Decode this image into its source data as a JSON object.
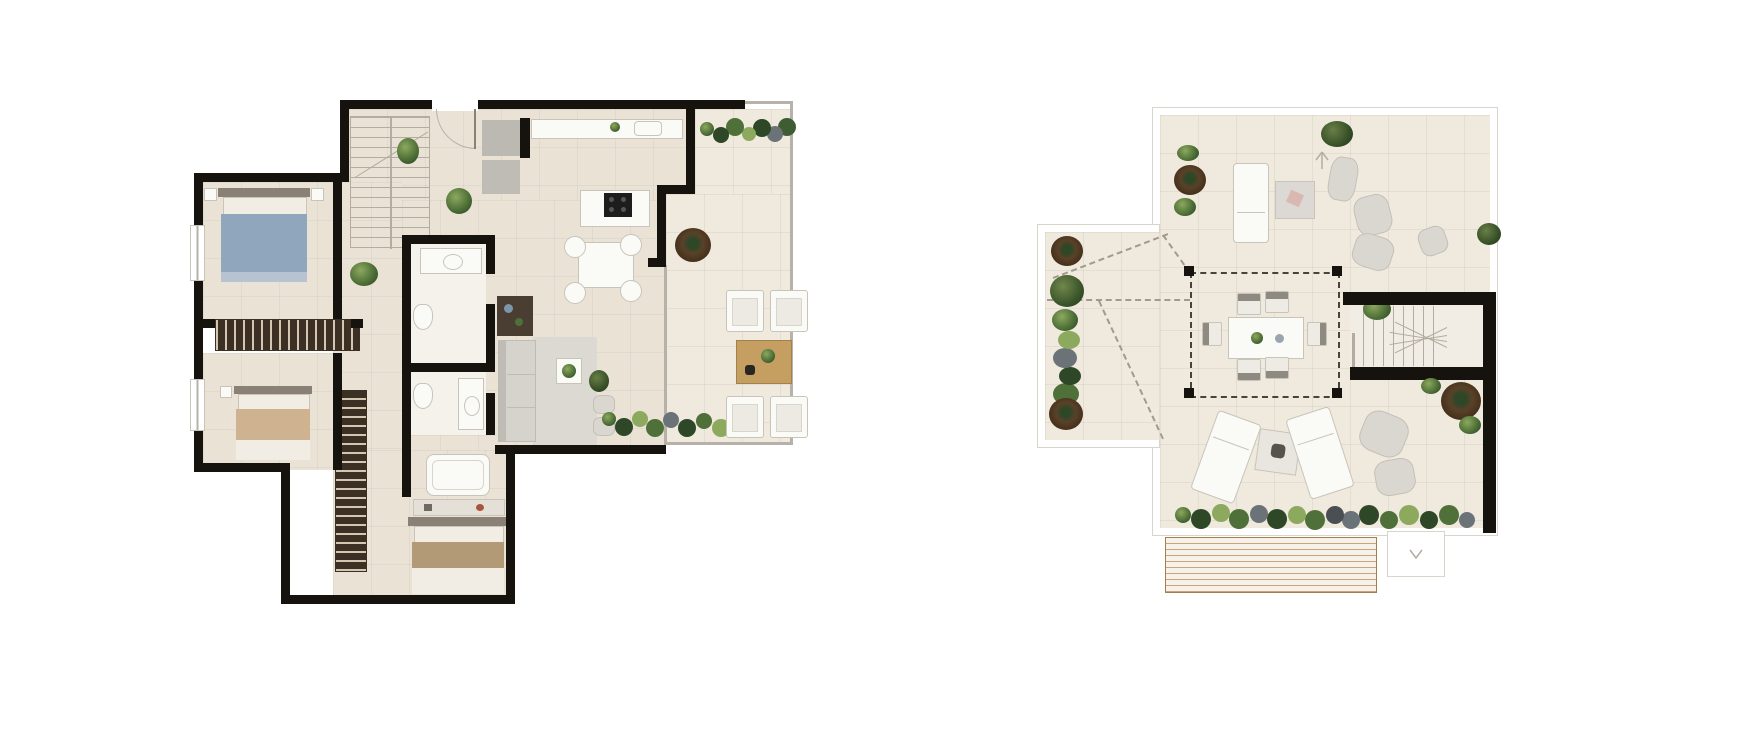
{
  "title": "Penthouse floor plans — interior level and rooftop solarium",
  "canvas": {
    "width": 1760,
    "height": 740,
    "background": "#ffffff"
  },
  "palette": {
    "wall": "#16130f",
    "floor": "#e9e2d5",
    "floor-light": "#f0e9dd",
    "white": "#fafaf7",
    "line": "#c9c4ba",
    "line-light": "#d9d5cc",
    "glass": "#b7b2a9",
    "wardrobe-dark": "#3b3023",
    "wardrobe-light": "#d3c6b2",
    "bed-blue": "#90a6bc",
    "bed-blue-light": "#b6c4d2",
    "headboard": "#8a8076",
    "linen-tan": "#cfb390",
    "linen-white": "#f1ede5",
    "sofa": "#d6d3cd",
    "sofa-dark": "#bfbcb5",
    "rug": "#dcd9d3",
    "cabinet": "#bcb9b3",
    "cooktop": "#1d1d1d",
    "wood": "#c59e62",
    "wood-dark": "#a27f4b",
    "plant": "#4f7038",
    "plant-dark": "#2d4727",
    "plant-light": "#8ca95e",
    "plant-gray": "#6b7378",
    "planter": "#5a4129",
    "planter-dark": "#33230f",
    "dash": "#a19a8d",
    "pergola-dash": "#474338",
    "slat": "#c8a57b",
    "deck-bg": "#f7f2e9",
    "stair-line": "#b3aca1"
  },
  "plans": [
    {
      "name": "Interior level floor plan",
      "rooms": [
        {
          "name": "Entry hall",
          "furniture": [
            "staircase",
            "potted plants"
          ]
        },
        {
          "name": "Kitchen",
          "furniture": [
            "worktop with sink",
            "tall cabinets",
            "island with cooktop"
          ]
        },
        {
          "name": "Dining area",
          "furniture": [
            "dining table",
            "4 round chairs"
          ]
        },
        {
          "name": "Living room",
          "furniture": [
            "sofa",
            "console table",
            "area rug",
            "coffee table with plant",
            "2 poufs",
            "floor plant"
          ]
        },
        {
          "name": "Bedroom 1",
          "furniture": [
            "double bed with blue bedding",
            "2 nightstands"
          ]
        },
        {
          "name": "Bedroom 2",
          "furniture": [
            "double bed with tan bedding",
            "nightstand"
          ]
        },
        {
          "name": "Bathroom 1",
          "furniture": [
            "vanity with basin",
            "toilet"
          ]
        },
        {
          "name": "Bathroom 2",
          "furniture": [
            "vanity with basin",
            "toilet"
          ]
        },
        {
          "name": "Master bedroom",
          "furniture": [
            "double bed",
            "bathtub",
            "shelf bench",
            "built-in wardrobe"
          ]
        },
        {
          "name": "Dressing corridor",
          "furniture": [
            "built-in wardrobe"
          ]
        },
        {
          "name": "Terrace",
          "furniture": [
            "4 lounge armchairs",
            "wooden coffee table",
            "round planter",
            "hedge planting top",
            "hedge planting bottom"
          ]
        }
      ],
      "windows": 2,
      "entry_doors": 1
    },
    {
      "name": "Rooftop solarium floor plan",
      "rooms": [
        {
          "name": "Upper sun deck",
          "furniture": [
            "sun lounger",
            "side table with towel",
            "4 poufs",
            "round planter with ferns",
            "corner shrubs"
          ]
        },
        {
          "name": "Pergola dining area",
          "furniture": [
            "dining table",
            "6 chairs",
            "4 pergola posts"
          ]
        },
        {
          "name": "West garden wing",
          "furniture": [
            "2 round planters",
            "tree",
            "hedge strip",
            "dashed roof ridge lines"
          ]
        },
        {
          "name": "Lower sun deck",
          "furniture": [
            "2 sun loungers",
            "low table with towel",
            "planting border"
          ]
        },
        {
          "name": "Stair core",
          "furniture": [
            "winder staircase",
            "bench rail",
            "round planter",
            "2 poufs",
            "ferns"
          ]
        },
        {
          "name": "Service deck",
          "furniture": [
            "slatted pergola roof",
            "landing step"
          ]
        }
      ],
      "symbols": [
        "north-arrow"
      ]
    }
  ]
}
